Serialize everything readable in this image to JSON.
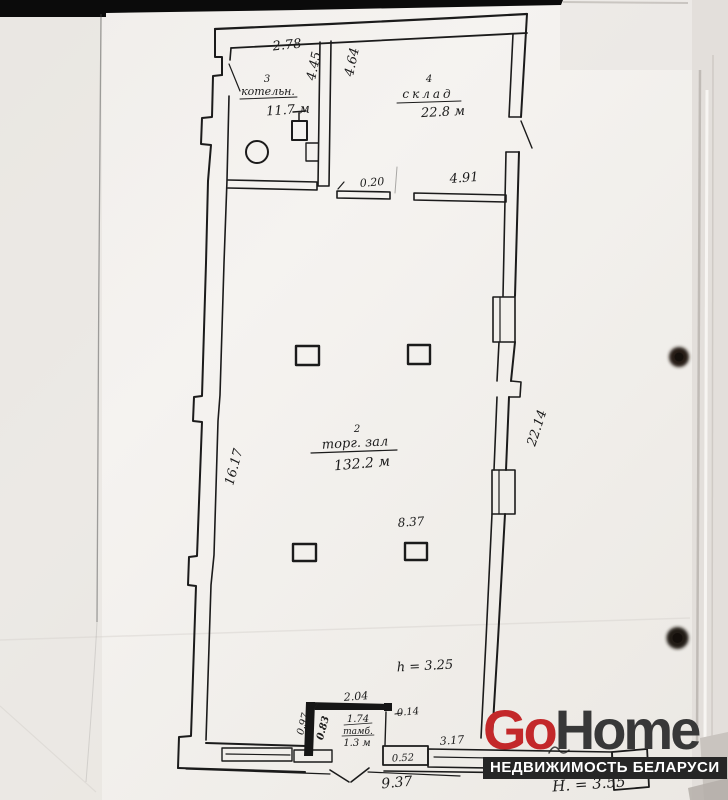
{
  "brand": {
    "logo_go": "Go",
    "logo_home": "Home",
    "tagline": "НЕДВИЖИМОСТЬ БЕЛАРУСИ",
    "colors": {
      "go": "#c3282a",
      "home": "#383838",
      "tagline_bg": "#262626",
      "tagline_text": "#ffffff"
    }
  },
  "plan": {
    "ink_color": "#1b1b1b",
    "paper_color": "#f3f1ed",
    "rooms": {
      "boiler": {
        "number": "3",
        "name": "котельн.",
        "area": "11.7 м"
      },
      "warehouse": {
        "number": "4",
        "name": "склад",
        "area": "22.8 м"
      },
      "trade_hall": {
        "number": "2",
        "name": "торг. зал",
        "area": "132.2 м"
      },
      "vestibule": {
        "name": "тамб.",
        "area": "1.3 м"
      }
    },
    "dimensions": {
      "boiler_width": "2.78",
      "boiler_depth": "4.45",
      "warehouse_depth": "4.64",
      "warehouse_sill_small": "0.20",
      "warehouse_sill_large": "4.91",
      "hall_left_side": "16.17",
      "hall_right_side": "22.14",
      "hall_width": "8.37",
      "ceiling_height": "h = 3.25",
      "vestibule_outer_width": "2.04",
      "vestibule_inner_width": "1.74",
      "vestibule_side_a": "0.97",
      "vestibule_side_b": "0.83",
      "vestibule_stub": "0.14",
      "porch_step": "0.52",
      "bottom_right_segment": "3.17",
      "bottom_total": "9.37",
      "building_height": "Н. = 3.55"
    }
  }
}
